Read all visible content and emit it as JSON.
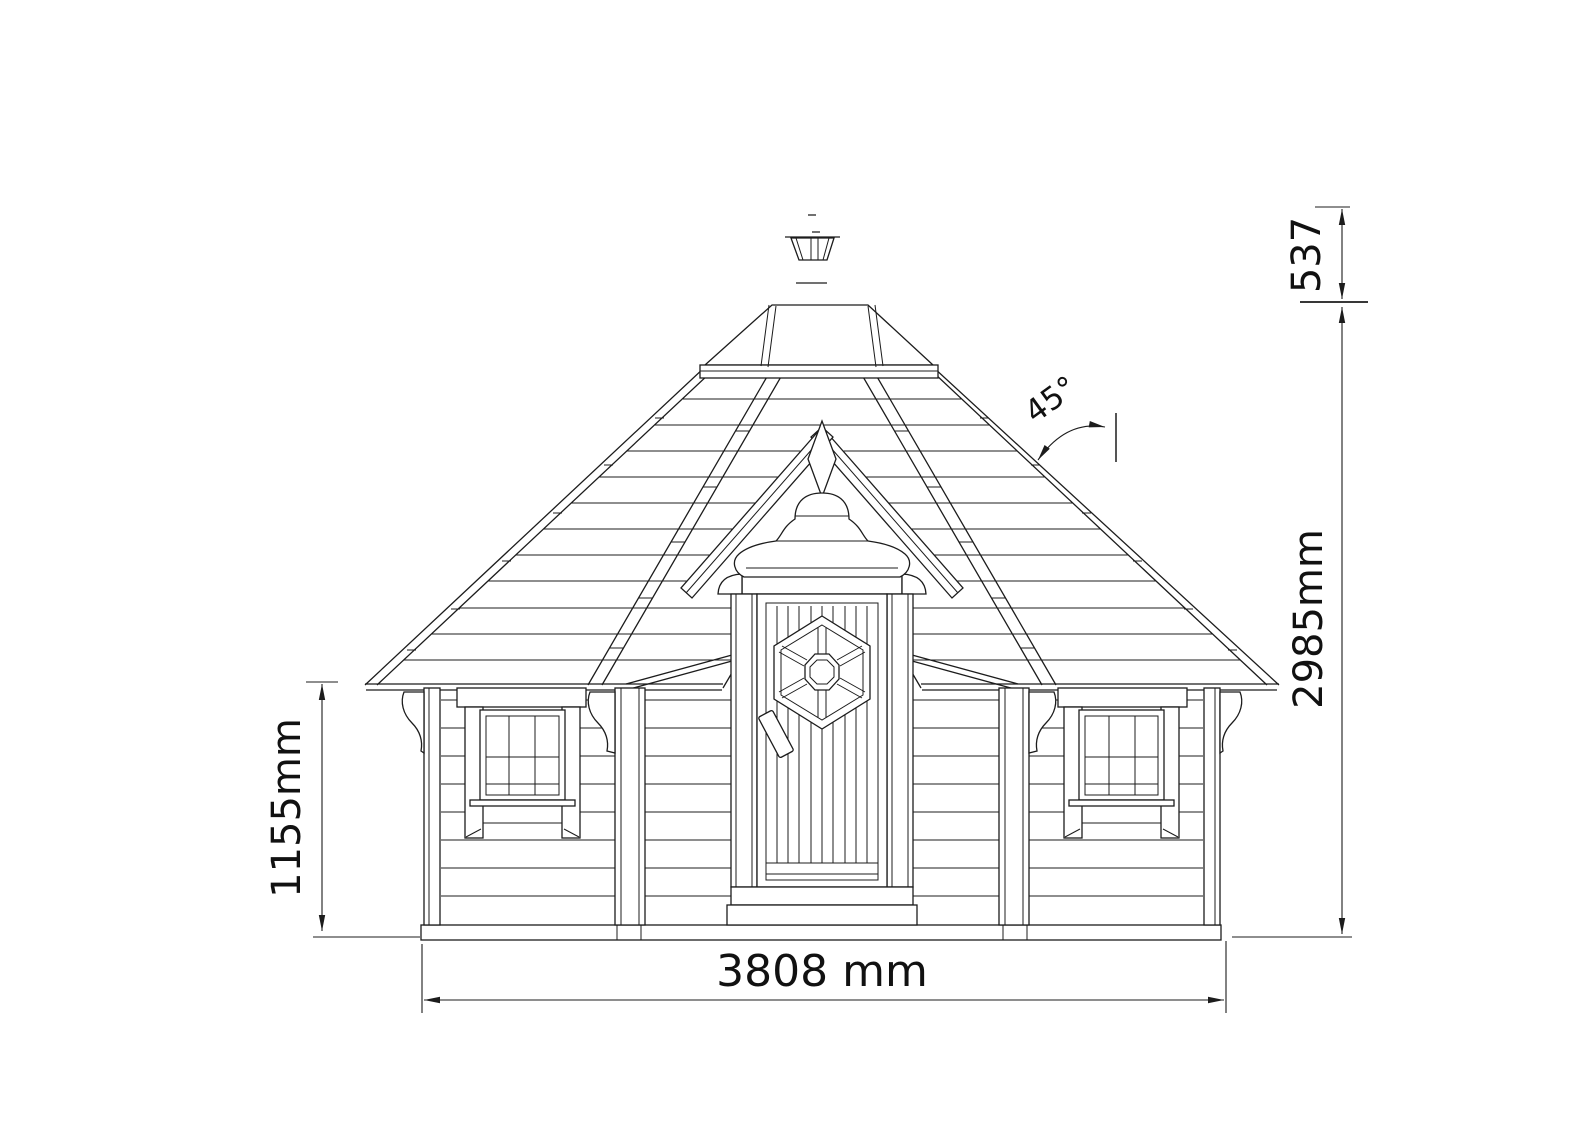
{
  "meta": {
    "type": "technical-elevation-drawing",
    "subject": "octagonal bbq hut / grill cabin front elevation"
  },
  "colors": {
    "background": "#ffffff",
    "line": "#1c1c1c",
    "text": "#111111"
  },
  "dims": {
    "wall_height": "1155mm",
    "total_height": "2985mm",
    "chimney_offset": "537",
    "base_width": "3808 mm",
    "roof_angle": "45°"
  }
}
